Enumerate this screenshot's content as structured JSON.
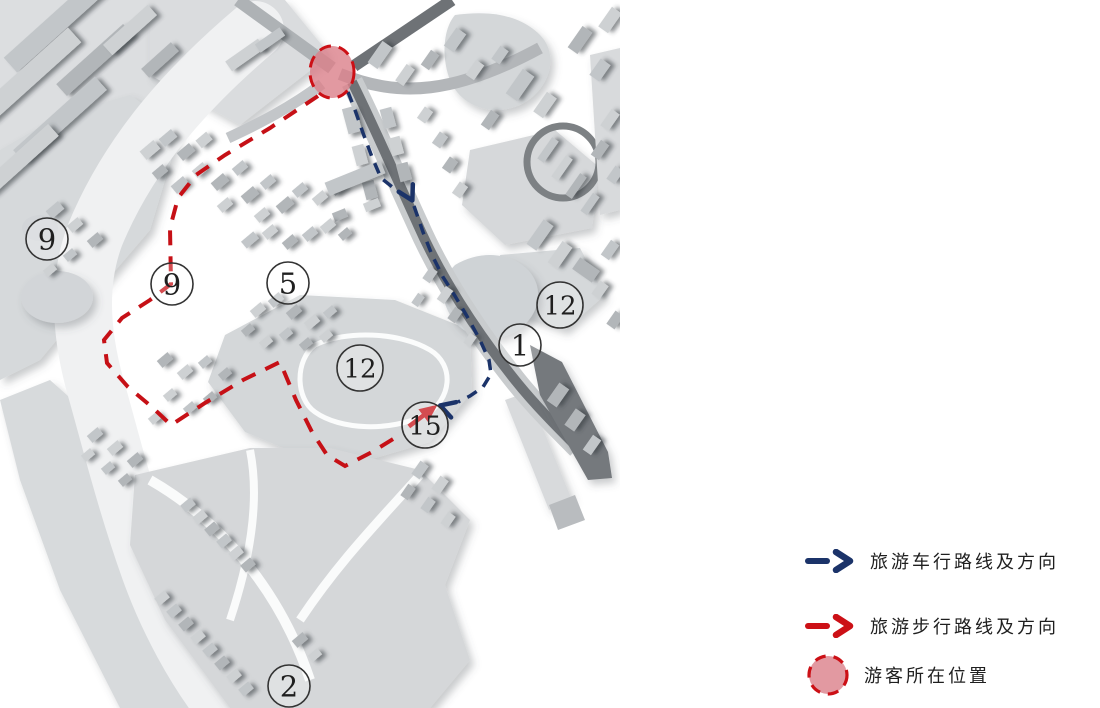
{
  "legend": {
    "items": [
      {
        "id": "vehicle-route",
        "icon": "dash-arrow",
        "color": "#1b3369",
        "label": "旅游车行路线及方向"
      },
      {
        "id": "walking-route",
        "icon": "dash-arrow",
        "color": "#cc1016",
        "label": "旅游步行路线及方向"
      },
      {
        "id": "visitor-location",
        "icon": "dashed-circle",
        "color": "#cc1016",
        "fill": "#db7f89",
        "label": "游客所在位置"
      }
    ]
  },
  "map": {
    "visitor_marker": {
      "x": 332,
      "y": 72,
      "rx": 22,
      "ry": 26,
      "stroke": "#cc1016",
      "fill": "#db7f89",
      "fill_opacity": 0.8
    },
    "location_markers": [
      {
        "label": "9",
        "x": 47,
        "y": 239
      },
      {
        "label": "9",
        "x": 172,
        "y": 284
      },
      {
        "label": "5",
        "x": 288,
        "y": 283
      },
      {
        "label": "12",
        "x": 360,
        "y": 368
      },
      {
        "label": "12",
        "x": 560,
        "y": 305
      },
      {
        "label": "1",
        "x": 520,
        "y": 345
      },
      {
        "label": "15",
        "x": 425,
        "y": 425
      },
      {
        "label": "2",
        "x": 289,
        "y": 686
      }
    ],
    "routes": {
      "vehicle": {
        "color": "#1b3369",
        "dash": "11 8",
        "width": 3.5,
        "segments": [
          [
            [
              348,
              92
            ],
            [
              355,
              110
            ],
            [
              363,
              133
            ],
            [
              372,
              157
            ],
            [
              381,
              178
            ],
            [
              396,
              190
            ]
          ],
          [
            [
              414,
              206
            ],
            [
              423,
              232
            ],
            [
              432,
              255
            ],
            [
              443,
              277
            ],
            [
              455,
              296
            ],
            [
              468,
              318
            ],
            [
              480,
              340
            ],
            [
              489,
              360
            ],
            [
              491,
              374
            ],
            [
              483,
              387
            ],
            [
              470,
              396
            ],
            [
              458,
              402
            ]
          ]
        ],
        "arrows": [
          {
            "type": "chevron",
            "x": 410,
            "y": 196,
            "angle": 62
          },
          {
            "type": "chevron",
            "x": 445,
            "y": 407,
            "angle": 198
          }
        ]
      },
      "walking": {
        "color": "#c61016",
        "dash": "15 11",
        "width": 4,
        "segments": [
          [
            [
              318,
              96
            ],
            [
              270,
              128
            ],
            [
              225,
              155
            ],
            [
              196,
              175
            ],
            [
              178,
              198
            ],
            [
              170,
              228
            ],
            [
              171,
              284
            ],
            [
              150,
              300
            ],
            [
              122,
              318
            ],
            [
              104,
              340
            ],
            [
              107,
              363
            ],
            [
              128,
              387
            ],
            [
              152,
              407
            ],
            [
              171,
              425
            ],
            [
              205,
              403
            ],
            [
              243,
              380
            ],
            [
              280,
              362
            ],
            [
              296,
              400
            ],
            [
              312,
              432
            ],
            [
              327,
              455
            ],
            [
              345,
              466
            ],
            [
              372,
              452
            ],
            [
              398,
              436
            ]
          ]
        ],
        "arrows": [
          {
            "type": "solid",
            "x": 428,
            "y": 412,
            "angle": -37
          }
        ]
      }
    }
  }
}
